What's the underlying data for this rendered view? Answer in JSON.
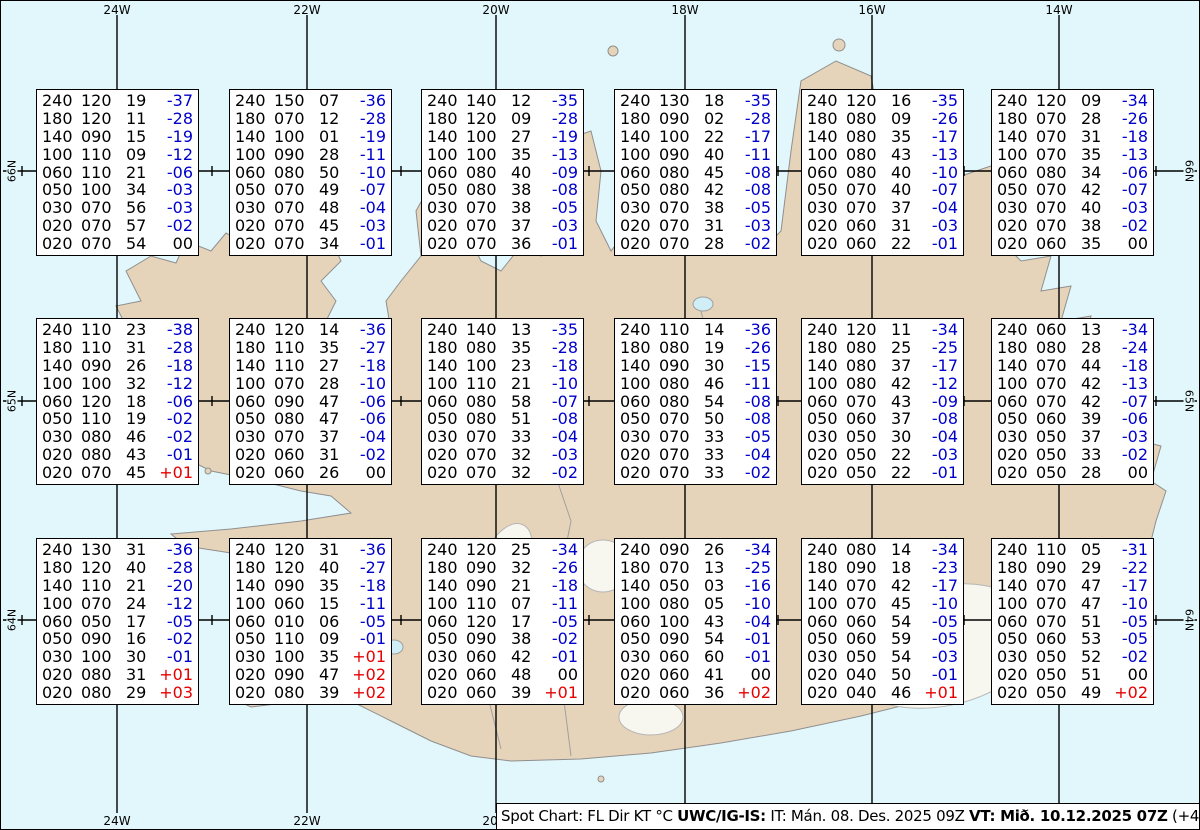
{
  "frame": {
    "top_labels": [
      "24W",
      "22W",
      "20W",
      "18W",
      "16W",
      "14W"
    ],
    "bottom_labels": [
      "24W",
      "22W",
      "20W"
    ],
    "left_labels": [
      "66N",
      "65N",
      "64N"
    ],
    "right_labels": [
      "66N",
      "65N",
      "64N"
    ]
  },
  "caption": {
    "segments": [
      {
        "text": "Spot Chart: FL Dir KT °C ",
        "bold": false
      },
      {
        "text": "UWC/IG-IS:",
        "bold": true
      },
      {
        "text": " IT: Mán. 08. Des. 2025 09Z ",
        "bold": false
      },
      {
        "text": "VT: Mið. 10.12.2025 07Z",
        "bold": true
      },
      {
        "text": " (+46 h)",
        "bold": false
      }
    ]
  },
  "colors": {
    "ocean": "#e2f7fb",
    "land": "#e6d4ba",
    "coast": "#8f8f8f",
    "grid": "#000000",
    "temp_negative": "#0000cc",
    "temp_positive": "#e60000",
    "temp_zero": "#000000"
  },
  "columns": [
    "FL",
    "Dir",
    "KT",
    "°C"
  ],
  "spots": [
    {
      "rows": [
        [
          "240",
          "120",
          "19",
          "-37"
        ],
        [
          "180",
          "120",
          "11",
          "-28"
        ],
        [
          "140",
          "090",
          "15",
          "-19"
        ],
        [
          "100",
          "110",
          "09",
          "-12"
        ],
        [
          "060",
          "110",
          "21",
          "-06"
        ],
        [
          "050",
          "100",
          "34",
          "-03"
        ],
        [
          "030",
          "070",
          "56",
          "-03"
        ],
        [
          "020",
          "070",
          "57",
          "-02"
        ],
        [
          "020",
          "070",
          "54",
          "00"
        ]
      ]
    },
    {
      "rows": [
        [
          "240",
          "150",
          "07",
          "-36"
        ],
        [
          "180",
          "070",
          "12",
          "-28"
        ],
        [
          "140",
          "100",
          "01",
          "-19"
        ],
        [
          "100",
          "090",
          "28",
          "-11"
        ],
        [
          "060",
          "080",
          "50",
          "-10"
        ],
        [
          "050",
          "070",
          "49",
          "-07"
        ],
        [
          "030",
          "070",
          "48",
          "-04"
        ],
        [
          "020",
          "070",
          "45",
          "-03"
        ],
        [
          "020",
          "070",
          "34",
          "-01"
        ]
      ]
    },
    {
      "rows": [
        [
          "240",
          "140",
          "12",
          "-35"
        ],
        [
          "180",
          "120",
          "09",
          "-28"
        ],
        [
          "140",
          "100",
          "27",
          "-19"
        ],
        [
          "100",
          "100",
          "35",
          "-13"
        ],
        [
          "060",
          "080",
          "40",
          "-09"
        ],
        [
          "050",
          "080",
          "38",
          "-08"
        ],
        [
          "030",
          "070",
          "38",
          "-05"
        ],
        [
          "020",
          "070",
          "37",
          "-03"
        ],
        [
          "020",
          "070",
          "36",
          "-01"
        ]
      ]
    },
    {
      "rows": [
        [
          "240",
          "130",
          "18",
          "-35"
        ],
        [
          "180",
          "090",
          "02",
          "-28"
        ],
        [
          "140",
          "100",
          "22",
          "-17"
        ],
        [
          "100",
          "090",
          "40",
          "-11"
        ],
        [
          "060",
          "080",
          "45",
          "-08"
        ],
        [
          "050",
          "080",
          "42",
          "-08"
        ],
        [
          "030",
          "070",
          "38",
          "-05"
        ],
        [
          "020",
          "070",
          "31",
          "-03"
        ],
        [
          "020",
          "070",
          "28",
          "-02"
        ]
      ]
    },
    {
      "rows": [
        [
          "240",
          "120",
          "16",
          "-35"
        ],
        [
          "180",
          "080",
          "09",
          "-26"
        ],
        [
          "140",
          "080",
          "35",
          "-17"
        ],
        [
          "100",
          "080",
          "43",
          "-13"
        ],
        [
          "060",
          "080",
          "40",
          "-10"
        ],
        [
          "050",
          "070",
          "40",
          "-07"
        ],
        [
          "030",
          "070",
          "37",
          "-04"
        ],
        [
          "020",
          "060",
          "31",
          "-03"
        ],
        [
          "020",
          "060",
          "22",
          "-01"
        ]
      ]
    },
    {
      "rows": [
        [
          "240",
          "120",
          "09",
          "-34"
        ],
        [
          "180",
          "070",
          "28",
          "-26"
        ],
        [
          "140",
          "070",
          "31",
          "-18"
        ],
        [
          "100",
          "070",
          "35",
          "-13"
        ],
        [
          "060",
          "080",
          "34",
          "-06"
        ],
        [
          "050",
          "070",
          "42",
          "-07"
        ],
        [
          "030",
          "070",
          "40",
          "-03"
        ],
        [
          "020",
          "070",
          "38",
          "-02"
        ],
        [
          "020",
          "060",
          "35",
          "00"
        ]
      ]
    },
    {
      "rows": [
        [
          "240",
          "110",
          "23",
          "-38"
        ],
        [
          "180",
          "110",
          "31",
          "-28"
        ],
        [
          "140",
          "090",
          "26",
          "-18"
        ],
        [
          "100",
          "100",
          "32",
          "-12"
        ],
        [
          "060",
          "120",
          "18",
          "-06"
        ],
        [
          "050",
          "110",
          "19",
          "-02"
        ],
        [
          "030",
          "080",
          "46",
          "-02"
        ],
        [
          "020",
          "080",
          "43",
          "-01"
        ],
        [
          "020",
          "070",
          "45",
          "+01"
        ]
      ]
    },
    {
      "rows": [
        [
          "240",
          "120",
          "14",
          "-36"
        ],
        [
          "180",
          "110",
          "35",
          "-27"
        ],
        [
          "140",
          "110",
          "27",
          "-18"
        ],
        [
          "100",
          "070",
          "28",
          "-10"
        ],
        [
          "060",
          "090",
          "47",
          "-06"
        ],
        [
          "050",
          "080",
          "47",
          "-06"
        ],
        [
          "030",
          "070",
          "37",
          "-04"
        ],
        [
          "020",
          "060",
          "31",
          "-02"
        ],
        [
          "020",
          "060",
          "26",
          "00"
        ]
      ]
    },
    {
      "rows": [
        [
          "240",
          "140",
          "13",
          "-35"
        ],
        [
          "180",
          "080",
          "35",
          "-28"
        ],
        [
          "140",
          "100",
          "23",
          "-18"
        ],
        [
          "100",
          "110",
          "21",
          "-10"
        ],
        [
          "060",
          "080",
          "58",
          "-07"
        ],
        [
          "050",
          "080",
          "51",
          "-08"
        ],
        [
          "030",
          "070",
          "33",
          "-04"
        ],
        [
          "020",
          "070",
          "32",
          "-03"
        ],
        [
          "020",
          "070",
          "32",
          "-02"
        ]
      ]
    },
    {
      "rows": [
        [
          "240",
          "110",
          "14",
          "-36"
        ],
        [
          "180",
          "080",
          "19",
          "-26"
        ],
        [
          "140",
          "090",
          "30",
          "-15"
        ],
        [
          "100",
          "080",
          "46",
          "-11"
        ],
        [
          "060",
          "080",
          "54",
          "-08"
        ],
        [
          "050",
          "070",
          "50",
          "-08"
        ],
        [
          "030",
          "070",
          "33",
          "-05"
        ],
        [
          "020",
          "070",
          "33",
          "-04"
        ],
        [
          "020",
          "070",
          "33",
          "-02"
        ]
      ]
    },
    {
      "rows": [
        [
          "240",
          "120",
          "11",
          "-34"
        ],
        [
          "180",
          "080",
          "25",
          "-25"
        ],
        [
          "140",
          "080",
          "37",
          "-17"
        ],
        [
          "100",
          "080",
          "42",
          "-12"
        ],
        [
          "060",
          "070",
          "43",
          "-09"
        ],
        [
          "050",
          "060",
          "37",
          "-08"
        ],
        [
          "030",
          "050",
          "30",
          "-04"
        ],
        [
          "020",
          "050",
          "22",
          "-03"
        ],
        [
          "020",
          "050",
          "22",
          "-01"
        ]
      ]
    },
    {
      "rows": [
        [
          "240",
          "060",
          "13",
          "-34"
        ],
        [
          "180",
          "080",
          "28",
          "-24"
        ],
        [
          "140",
          "070",
          "44",
          "-18"
        ],
        [
          "100",
          "070",
          "42",
          "-13"
        ],
        [
          "060",
          "070",
          "42",
          "-07"
        ],
        [
          "050",
          "060",
          "39",
          "-06"
        ],
        [
          "030",
          "050",
          "37",
          "-03"
        ],
        [
          "020",
          "050",
          "33",
          "-02"
        ],
        [
          "020",
          "050",
          "28",
          "00"
        ]
      ]
    },
    {
      "rows": [
        [
          "240",
          "130",
          "31",
          "-36"
        ],
        [
          "180",
          "120",
          "40",
          "-28"
        ],
        [
          "140",
          "110",
          "21",
          "-20"
        ],
        [
          "100",
          "070",
          "24",
          "-12"
        ],
        [
          "060",
          "050",
          "17",
          "-05"
        ],
        [
          "050",
          "090",
          "16",
          "-02"
        ],
        [
          "030",
          "100",
          "30",
          "-01"
        ],
        [
          "020",
          "080",
          "31",
          "+01"
        ],
        [
          "020",
          "080",
          "29",
          "+03"
        ]
      ]
    },
    {
      "rows": [
        [
          "240",
          "120",
          "31",
          "-36"
        ],
        [
          "180",
          "120",
          "40",
          "-27"
        ],
        [
          "140",
          "090",
          "35",
          "-18"
        ],
        [
          "100",
          "060",
          "15",
          "-11"
        ],
        [
          "060",
          "010",
          "06",
          "-05"
        ],
        [
          "050",
          "110",
          "09",
          "-01"
        ],
        [
          "030",
          "100",
          "35",
          "+01"
        ],
        [
          "020",
          "090",
          "47",
          "+02"
        ],
        [
          "020",
          "080",
          "39",
          "+02"
        ]
      ]
    },
    {
      "rows": [
        [
          "240",
          "120",
          "25",
          "-34"
        ],
        [
          "180",
          "090",
          "32",
          "-26"
        ],
        [
          "140",
          "090",
          "21",
          "-18"
        ],
        [
          "100",
          "110",
          "07",
          "-11"
        ],
        [
          "060",
          "120",
          "17",
          "-05"
        ],
        [
          "050",
          "090",
          "38",
          "-02"
        ],
        [
          "030",
          "060",
          "42",
          "-01"
        ],
        [
          "020",
          "060",
          "48",
          "00"
        ],
        [
          "020",
          "060",
          "39",
          "+01"
        ]
      ]
    },
    {
      "rows": [
        [
          "240",
          "090",
          "26",
          "-34"
        ],
        [
          "180",
          "070",
          "13",
          "-25"
        ],
        [
          "140",
          "050",
          "03",
          "-16"
        ],
        [
          "100",
          "080",
          "05",
          "-10"
        ],
        [
          "060",
          "100",
          "43",
          "-04"
        ],
        [
          "050",
          "090",
          "54",
          "-01"
        ],
        [
          "030",
          "060",
          "60",
          "-01"
        ],
        [
          "020",
          "060",
          "41",
          "00"
        ],
        [
          "020",
          "060",
          "36",
          "+02"
        ]
      ]
    },
    {
      "rows": [
        [
          "240",
          "080",
          "14",
          "-34"
        ],
        [
          "180",
          "090",
          "18",
          "-23"
        ],
        [
          "140",
          "070",
          "42",
          "-17"
        ],
        [
          "100",
          "070",
          "45",
          "-10"
        ],
        [
          "060",
          "060",
          "54",
          "-05"
        ],
        [
          "050",
          "060",
          "59",
          "-05"
        ],
        [
          "030",
          "050",
          "54",
          "-03"
        ],
        [
          "020",
          "040",
          "50",
          "-01"
        ],
        [
          "020",
          "040",
          "46",
          "+01"
        ]
      ]
    },
    {
      "rows": [
        [
          "240",
          "110",
          "05",
          "-31"
        ],
        [
          "180",
          "090",
          "29",
          "-22"
        ],
        [
          "140",
          "070",
          "47",
          "-17"
        ],
        [
          "100",
          "070",
          "47",
          "-10"
        ],
        [
          "060",
          "070",
          "51",
          "-05"
        ],
        [
          "050",
          "060",
          "53",
          "-05"
        ],
        [
          "030",
          "050",
          "52",
          "-02"
        ],
        [
          "020",
          "050",
          "51",
          "00"
        ],
        [
          "020",
          "050",
          "49",
          "+02"
        ]
      ]
    }
  ]
}
